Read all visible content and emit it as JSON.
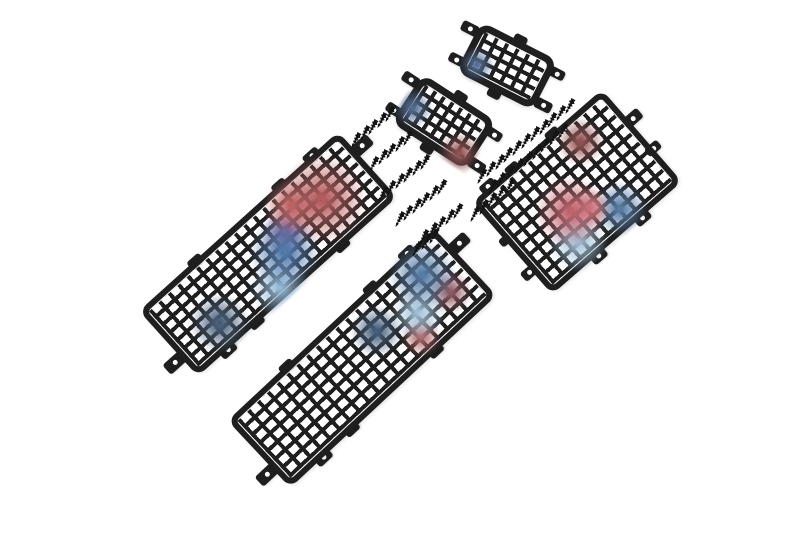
{
  "scene": {
    "description": "Five black steel mesh window-protection panels of different sizes laid diagonally on a white background, with two clusters of small black self-tapping mounting screws between them. Faint red and blue light reflections tint parts of the mesh.",
    "object_counts": {
      "mesh_panels": 5,
      "screws": 55
    },
    "colors": {
      "background": "#ffffff",
      "metal": "#1f1f1f",
      "screw": "#141414",
      "reflection_red": "#b64a4a",
      "reflection_pink": "#d87880",
      "reflection_blue": "#3f6ea6",
      "reflection_light_blue": "#9fc3dc",
      "reflection_purple": "#6a4a8a"
    },
    "panels": [
      {
        "id": "small-top",
        "label": "small mesh panel (top)",
        "cx": 507,
        "cy": 66,
        "w": 86,
        "h": 56,
        "rot": 27,
        "frame": 7,
        "r": 12,
        "line": 4,
        "cols": 6,
        "rows": 4,
        "tabs": [
          {
            "x": -7,
            "y": 11,
            "w": 18,
            "h": 11,
            "hole": true
          },
          {
            "x": -5,
            "y": 45,
            "w": 16,
            "h": 10,
            "hole": true
          },
          {
            "x": 91,
            "y": 12,
            "w": 16,
            "h": 10,
            "hole": true
          },
          {
            "x": 93,
            "y": 46,
            "w": 18,
            "h": 11,
            "hole": true
          },
          {
            "x": 43,
            "y": -2,
            "w": 14,
            "h": 9,
            "hole": false
          },
          {
            "x": 44,
            "y": 58,
            "w": 14,
            "h": 9,
            "hole": false
          }
        ],
        "tints": [
          {
            "x": 20,
            "y": 70,
            "r": 18,
            "c": "#41618c"
          }
        ]
      },
      {
        "id": "small-mid",
        "label": "small mesh panel (middle)",
        "cx": 444,
        "cy": 122,
        "w": 88,
        "h": 58,
        "rot": 33,
        "frame": 7,
        "r": 12,
        "line": 4,
        "cols": 7,
        "rows": 4,
        "tabs": [
          {
            "x": -7,
            "y": 11,
            "w": 18,
            "h": 11,
            "hole": true
          },
          {
            "x": -5,
            "y": 46,
            "w": 16,
            "h": 10,
            "hole": true
          },
          {
            "x": 93,
            "y": 12,
            "w": 16,
            "h": 10,
            "hole": true
          },
          {
            "x": 95,
            "y": 47,
            "w": 18,
            "h": 11,
            "hole": true
          },
          {
            "x": 44,
            "y": -2,
            "w": 14,
            "h": 9,
            "hole": false
          },
          {
            "x": 44,
            "y": 60,
            "w": 14,
            "h": 9,
            "hole": false
          }
        ],
        "tints": [
          {
            "x": 82,
            "y": 78,
            "r": 22,
            "c": "#8a4040"
          },
          {
            "x": 14,
            "y": 58,
            "r": 20,
            "c": "#40608a"
          }
        ]
      },
      {
        "id": "right-large",
        "label": "wide mesh panel (right)",
        "cx": 577,
        "cy": 192,
        "w": 172,
        "h": 122,
        "rot": -41,
        "frame": 6,
        "r": 10,
        "line": 4,
        "cols": 13,
        "rows": 9,
        "tabs": [
          {
            "x": 52,
            "y": 0,
            "w": 15,
            "h": 9,
            "hole": false
          },
          {
            "x": 105,
            "y": 0,
            "w": 15,
            "h": 9,
            "hole": false
          },
          {
            "x": 22,
            "y": -2,
            "w": 17,
            "h": 11,
            "hole": true
          },
          {
            "x": 176,
            "y": 42,
            "w": 20,
            "h": 12,
            "hole": true
          },
          {
            "x": 172,
            "y": 78,
            "w": 16,
            "h": 10,
            "hole": true
          },
          {
            "x": 60,
            "y": 123,
            "w": 17,
            "h": 11,
            "hole": true
          },
          {
            "x": 118,
            "y": 123,
            "w": 17,
            "h": 11,
            "hole": true
          },
          {
            "x": -3,
            "y": 90,
            "w": 16,
            "h": 11,
            "hole": true
          },
          {
            "x": 0,
            "y": 50,
            "w": 12,
            "h": 9,
            "hole": false
          }
        ],
        "tints": [
          {
            "x": 40,
            "y": 58,
            "r": 36,
            "c": "#bf5560"
          },
          {
            "x": 50,
            "y": 66,
            "r": 20,
            "c": "#d87880"
          },
          {
            "x": 32,
            "y": 80,
            "r": 30,
            "c": "#9fc3dc"
          },
          {
            "x": 62,
            "y": 82,
            "r": 28,
            "c": "#46719f"
          },
          {
            "x": 70,
            "y": 22,
            "r": 24,
            "c": "#8a4040"
          }
        ]
      },
      {
        "id": "left-long",
        "label": "long mesh panel (left)",
        "cx": 268,
        "cy": 254,
        "w": 268,
        "h": 88,
        "rot": -42,
        "frame": 6,
        "r": 10,
        "line": 4,
        "cols": 20,
        "rows": 7,
        "tabs": [
          {
            "x": 75,
            "y": 1,
            "w": 16,
            "h": 10,
            "hole": false
          },
          {
            "x": 188,
            "y": 1,
            "w": 16,
            "h": 10,
            "hole": false
          },
          {
            "x": 232,
            "y": 0,
            "w": 18,
            "h": 11,
            "hole": true
          },
          {
            "x": 276,
            "y": 26,
            "w": 22,
            "h": 13,
            "hole": true
          },
          {
            "x": 80,
            "y": 87,
            "w": 16,
            "h": 10,
            "hole": false
          },
          {
            "x": 195,
            "y": 87,
            "w": 16,
            "h": 10,
            "hole": false
          },
          {
            "x": 40,
            "y": 88,
            "w": 18,
            "h": 11,
            "hole": true
          },
          {
            "x": -8,
            "y": 62,
            "w": 22,
            "h": 13,
            "hole": true
          }
        ],
        "tints": [
          {
            "x": 78,
            "y": 45,
            "r": 45,
            "c": "#b04c4c"
          },
          {
            "x": 68,
            "y": 28,
            "r": 28,
            "c": "#c25b5b"
          },
          {
            "x": 55,
            "y": 60,
            "r": 36,
            "c": "#3f6ea6"
          },
          {
            "x": 45,
            "y": 85,
            "r": 30,
            "c": "#8fb8d8"
          },
          {
            "x": 60,
            "y": 45,
            "r": 24,
            "c": "#6a4a8a"
          },
          {
            "x": 20,
            "y": 70,
            "r": 30,
            "c": "#35506e"
          }
        ]
      },
      {
        "id": "bottom-long",
        "label": "long mesh panel (bottom)",
        "cx": 362,
        "cy": 358,
        "w": 282,
        "h": 92,
        "rot": -43,
        "frame": 6,
        "r": 10,
        "line": 4,
        "cols": 20,
        "rows": 7,
        "tabs": [
          {
            "x": 80,
            "y": 1,
            "w": 16,
            "h": 10,
            "hole": false
          },
          {
            "x": 195,
            "y": 1,
            "w": 16,
            "h": 10,
            "hole": false
          },
          {
            "x": 245,
            "y": 0,
            "w": 18,
            "h": 11,
            "hole": true
          },
          {
            "x": 290,
            "y": 28,
            "w": 22,
            "h": 13,
            "hole": true
          },
          {
            "x": 85,
            "y": 91,
            "w": 16,
            "h": 10,
            "hole": false
          },
          {
            "x": 200,
            "y": 91,
            "w": 16,
            "h": 10,
            "hole": false
          },
          {
            "x": 45,
            "y": 92,
            "w": 18,
            "h": 11,
            "hole": true
          },
          {
            "x": -8,
            "y": 66,
            "w": 22,
            "h": 13,
            "hole": true
          }
        ],
        "tints": [
          {
            "x": 85,
            "y": 30,
            "r": 34,
            "c": "#46719f"
          },
          {
            "x": 75,
            "y": 55,
            "r": 28,
            "c": "#9fc3dc"
          },
          {
            "x": 88,
            "y": 62,
            "r": 22,
            "c": "#8a4a55"
          },
          {
            "x": 60,
            "y": 40,
            "r": 26,
            "c": "#2f4f6f"
          },
          {
            "x": 70,
            "y": 75,
            "r": 20,
            "c": "#b05a5a"
          }
        ]
      }
    ],
    "screws": {
      "w": 7,
      "h": 17,
      "rot": 28,
      "rows": [
        {
          "x": 386,
          "y": 106,
          "n": 5,
          "dx": -8.4,
          "dy": 6.4
        },
        {
          "x": 404,
          "y": 130,
          "n": 5,
          "dx": -8.4,
          "dy": 6.4
        },
        {
          "x": 421,
          "y": 154,
          "n": 6,
          "dx": -8.4,
          "dy": 6.4
        },
        {
          "x": 438,
          "y": 179,
          "n": 6,
          "dx": -8.4,
          "dy": 6.4
        },
        {
          "x": 454,
          "y": 203,
          "n": 5,
          "dx": -8.4,
          "dy": 6.4
        },
        {
          "x": 430,
          "y": 228,
          "n": 3,
          "dx": -8.4,
          "dy": 6.4
        },
        {
          "x": 566,
          "y": 98,
          "n": 11,
          "dx": -8.8,
          "dy": 7.0
        },
        {
          "x": 559,
          "y": 123,
          "n": 9,
          "dx": -8.8,
          "dy": 7.0
        },
        {
          "x": 506,
          "y": 178,
          "n": 5,
          "dx": -8.8,
          "dy": 7.0
        }
      ]
    }
  }
}
